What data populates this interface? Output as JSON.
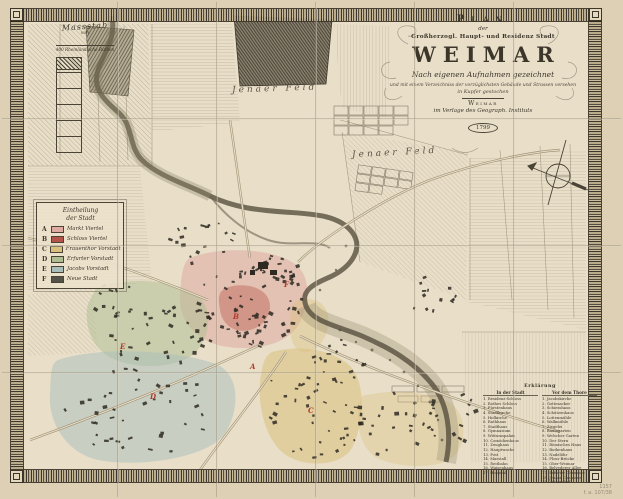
{
  "map": {
    "cartouche": {
      "plan": "Plan",
      "der": "der",
      "subtitle": "Großherzogl. Haupt- und Residenz Stadt",
      "city": "WEIMAR",
      "line1": "Nach eigenen Aufnahmen gezeichnet",
      "line2": "und mit einem Verzeichniss der vorzüglichsten Gebäude und Strassen versehen",
      "line3": "in Kupfer gestochen",
      "place": "Weimar",
      "publisher": "im Verlage des Geograph. Instituts",
      "year": "1799"
    },
    "scale": {
      "title": "Massstab",
      "von": "von",
      "unit": "400 Rheinländische Ruthen"
    },
    "legend": {
      "title_line1": "Eintheilung",
      "title_line2": "der Stadt",
      "entries": [
        {
          "letter": "A",
          "color": "#dfaaa2",
          "label": "Markt Viertel"
        },
        {
          "letter": "B",
          "color": "#b5544a",
          "label": "Schloss Viertel"
        },
        {
          "letter": "C",
          "color": "#d9c07c",
          "label": "Frauenthor Vorstadt"
        },
        {
          "letter": "D",
          "color": "#aebd92",
          "label": "Erfurter Vorstadt"
        },
        {
          "letter": "E",
          "color": "#a9bdbb",
          "label": "Jacobs Vorstadt"
        },
        {
          "letter": "F",
          "color": "#55524a",
          "label": "Neue Stadt"
        }
      ]
    },
    "field_labels": [
      {
        "text": "Jenaer Feld"
      },
      {
        "text": "Jenaer Feld"
      }
    ],
    "district_letters": [
      "A",
      "B",
      "C",
      "D",
      "E",
      "F"
    ],
    "explanation": {
      "title": "Erklärung",
      "col1_header": "In der Stadt",
      "col2_header": "Vor dem Thore",
      "col1": [
        "1. Residenz-Schloss",
        "2. Rothes Schloss",
        "3. Fürstenhaus",
        "4. Stadtkirche",
        "5. Hofkirche",
        "6. Rathhaus",
        "7. Stadthaus",
        "8. Gymnasium",
        "9. Wittumspalais",
        "10. Comödienhaus",
        "11. Zeughaus",
        "12. Hauptwache",
        "13. Post",
        "14. Marstall",
        "15. Reitbahn",
        "16. Waisenhaus",
        "17. Hospital"
      ],
      "col2": [
        "1. Jacobskirche",
        "2. Gottesacker",
        "3. Schiesshaus",
        "4. Schützenhaus",
        "5. Lottenmühle",
        "6. Walkmühle",
        "7. Ziegelei",
        "8. Baumgarten",
        "9. Welscher Garten",
        "10. Der Stern",
        "11. Römisches Haus",
        "12. Borkenhaus",
        "13. Nadelöhr",
        "14. Floss-Brücke",
        "15. Ober-Weimar",
        "16. Belvederer Allee",
        "17. Erfurter Chaussee",
        "18. Jenaer Chaussee",
        "19. Lützendorf"
      ]
    },
    "margin_note_line1": "1157",
    "margin_note_line2": "f. a. 107/38",
    "colors": {
      "paper": "#e9dfc9",
      "margin_paper": "#ddd0b4",
      "ink": "#3c352a",
      "river": "#57503f",
      "district_pink": "#dfaaa2",
      "district_red": "#b5544a",
      "district_yellow": "#d9c07c",
      "district_green": "#aebd92",
      "district_blue": "#a9bdbb",
      "letter_red": "#b03a2e"
    }
  }
}
